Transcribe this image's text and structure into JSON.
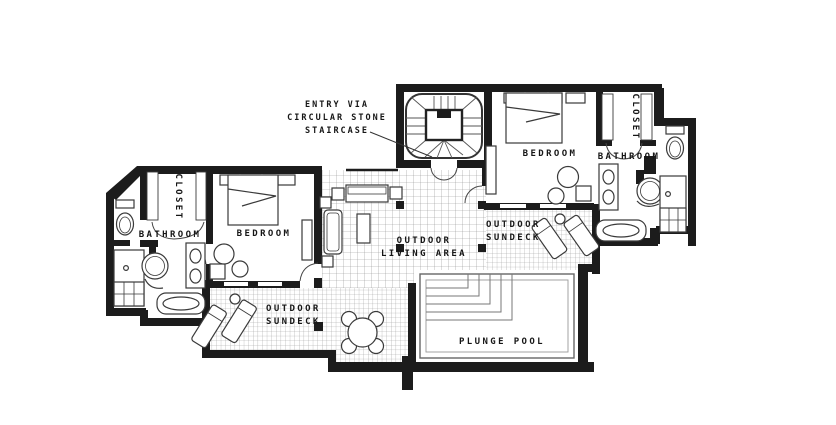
{
  "plan": {
    "annotation": {
      "line1": "ENTRY VIA",
      "line2": "CIRCULAR STONE",
      "line3": "STAIRCASE"
    },
    "left_wing": {
      "closet": "CLOSET",
      "bathroom": "BATHROOM",
      "bedroom": "BEDROOM"
    },
    "right_wing": {
      "closet": "CLOSET",
      "bathroom": "BATHROOM",
      "bedroom": "BEDROOM"
    },
    "living": {
      "line1": "OUTDOOR",
      "line2": "LIVING AREA"
    },
    "sundeck_left": {
      "line1": "OUTDOOR",
      "line2": "SUNDECK"
    },
    "sundeck_right": {
      "line1": "OUTDOOR",
      "line2": "SUNDECK"
    },
    "pool": {
      "label": "PLUNGE POOL"
    }
  },
  "colors": {
    "background": "#ffffff",
    "wall": "#1c1c1c",
    "line": "#3a3a3a",
    "tile_line": "#8f8f8f",
    "pool_line": "#777777",
    "text": "#161616"
  }
}
